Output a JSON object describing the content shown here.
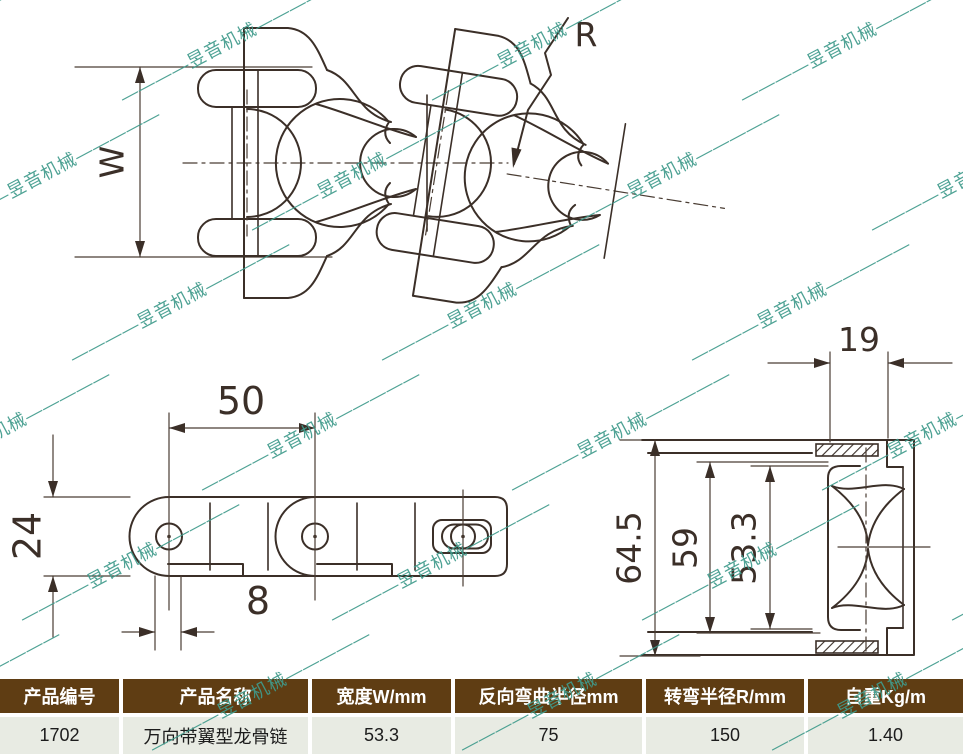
{
  "watermark": {
    "text": "————昱音机械—————",
    "color": "#3f9b8c"
  },
  "top_view": {
    "width_label": "W",
    "radius_label": "R"
  },
  "side_view": {
    "pitch": "50",
    "height": "24",
    "tab_width": "8"
  },
  "section_view": {
    "wing_thickness": "19",
    "outer_height": "64.5",
    "middle_height": "59",
    "inner_height": "53.3"
  },
  "table": {
    "headers": [
      "产品编号",
      "产品名称",
      "宽度W/mm",
      "反向弯曲半径mm",
      "转弯半径R/mm",
      "自重Kg/m"
    ],
    "rows": [
      [
        "1702",
        "万向带翼型龙骨链",
        "53.3",
        "75",
        "150",
        "1.40"
      ]
    ]
  },
  "colors": {
    "line": "#3b2f28",
    "watermark": "#3f9b8c",
    "table_header_bg": "#5f3d13",
    "table_header_text": "#ffffff",
    "table_row_bg": "#e8ebe3"
  }
}
